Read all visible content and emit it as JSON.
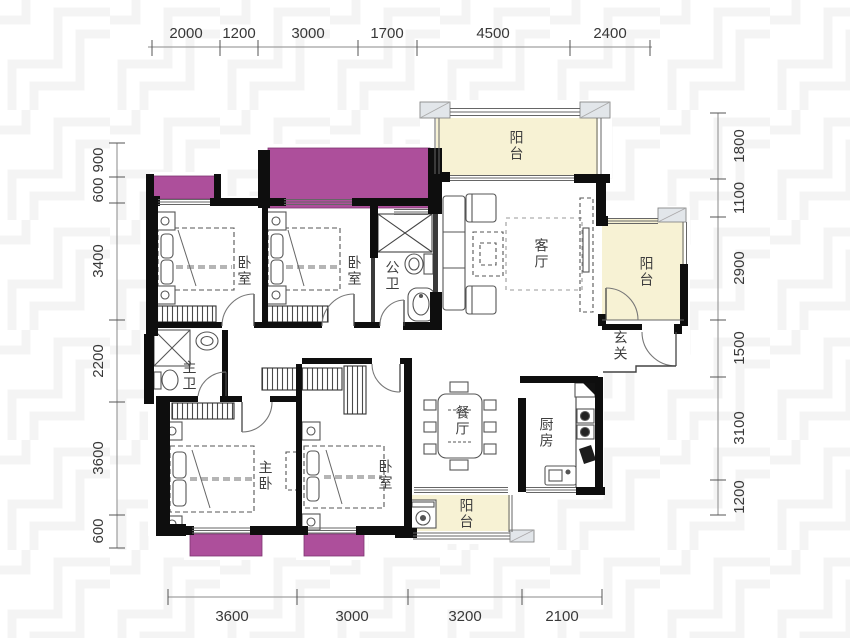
{
  "colors": {
    "bay_window": "#ad4f9b",
    "balcony_fill": "#f7f2d4",
    "wall": "#0e0e0e",
    "pillar_fill": "#e2e6ea",
    "dim_text": "#383838",
    "label_text": "#3e3e3e"
  },
  "dims": {
    "top": [
      "2000",
      "1200",
      "3000",
      "1700",
      "4500",
      "2400"
    ],
    "bottom": [
      "3600",
      "3000",
      "3200",
      "2100"
    ],
    "left": [
      "900",
      "600",
      "3400",
      "2200",
      "3600",
      "600"
    ],
    "right": [
      "1800",
      "1100",
      "2900",
      "1500",
      "3100",
      "1200"
    ]
  },
  "rooms": {
    "balcony_top": "阳台",
    "living_room": "客厅",
    "balcony_right": "阳台",
    "entry": "玄关",
    "bedroom_top_left": "卧室",
    "bedroom_top_mid": "卧室",
    "bath_public": "公卫",
    "bath_master": "主卫",
    "master_bedroom": "主卧",
    "bedroom_bottom": "卧室",
    "dining_room": "餐厅",
    "kitchen": "厨房",
    "balcony_bottom": "阳台"
  }
}
